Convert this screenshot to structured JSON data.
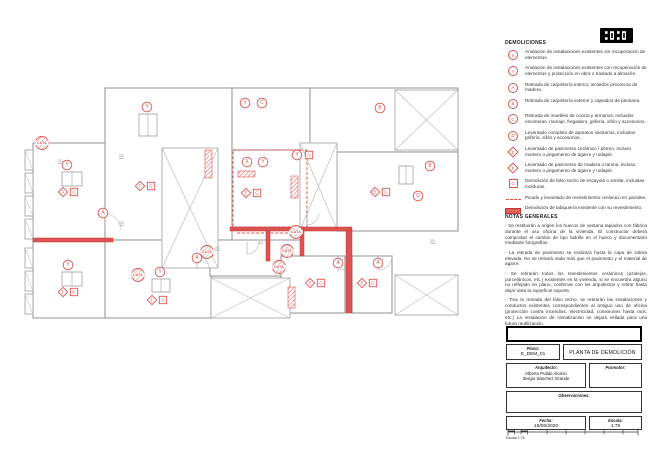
{
  "logo": {
    "name": "studio-logo"
  },
  "legend": {
    "title": "DEMOLICIONES",
    "items": [
      {
        "symbol": "circle",
        "letter": "X",
        "text": "Anulación de instalaciones existentes sin recuperación de elementos."
      },
      {
        "symbol": "circle",
        "letter": "Y",
        "text": "Anulación de instalaciones existentes con recuperación de elementos y protección en obra o traslado a almacén."
      },
      {
        "symbol": "circle",
        "letter": "A",
        "text": "Retirada de carpintería interior, incluidos precercos de madera."
      },
      {
        "symbol": "circle",
        "letter": "B",
        "text": "Retirada de carpintería exterior y cajeados de persiana."
      },
      {
        "symbol": "circle",
        "letter": "C",
        "text": "Retirada de muebles de cocina y armarios, incluidos encimeras, menaje, fregadero, grifería, sifón y accesorios."
      },
      {
        "symbol": "circle",
        "letter": "D",
        "text": "Levantado completo de aparatos sanitarios, incluidos grifería, sifón y accesorios."
      },
      {
        "symbol": "diamond",
        "letter": "E",
        "text": "Levantado de pavimento cerámico / pétreo, incluso mortero o pegamento de agarre y rodapié."
      },
      {
        "symbol": "diamond",
        "letter": "F",
        "text": "Levantado de pavimento de madera o tarima, incluso mortero o pegamento de agarre y rodapié."
      },
      {
        "symbol": "square",
        "letter": "G",
        "text": "Demolición de falso techo de escayola o similar, incluidas molduras."
      },
      {
        "symbol": "dashed-line",
        "letter": "",
        "text": "Picado y levantado de revestimiento cerámico en paredes."
      },
      {
        "symbol": "solid-wall",
        "letter": "",
        "text": "Demolición de tabiquería existente con su revestimiento."
      }
    ]
  },
  "notes": {
    "title": "NOTAS GENERALES",
    "paragraphs": [
      "- Se restituirán a origen los huecos de ventana tapiados con fábrica durante el uso oficina de la vivienda. El constructor deberá comprobar el cambio de tipo ladrillo en el hueco y documentarlo mediante fotografías.",
      "- La retirada de pavimento se realizará hasta la capa de solera elevada. No se retirará nada más que el pavimento y el material de agarre.",
      "- Se retirarán todos los revestimientos cerámicos (azulejos, porcelánicos, etc.) existentes en la vivienda, si se encuentra alguno no reflejado en plano, confirmar con los arquitectos y retirar hasta dejar vista la superficie soporte.",
      "- Tras la retirada del falso techo, se retirarán las instalaciones y conductos existentes correspondientes al antiguo uso de oficina (protección contra incendios, electricidad, conexiones hasta rack, etc.) La instalación de climatización se dejará sellada para una futura reutilización."
    ]
  },
  "titleblock": {
    "plano_label": "Plano:",
    "plano_value": "E_DEM_01",
    "title": "PLANTA DE DEMOLICIÓN",
    "arquitecto_label": "Arquitecto:",
    "arquitecto_names": [
      "Alberto Pulido Alonso",
      "Sergio Sánchez Grande"
    ],
    "promotor_label": "Promotor:",
    "observaciones_label": "Observaciones:",
    "fecha_label": "Fecha:",
    "fecha_value": "16/06/2020",
    "escala_label": "Escala:",
    "escala_value": "1:75",
    "scalebar_caption": "Escala 1:75"
  },
  "plan": {
    "colors": {
      "demolition_red": "#de5350",
      "demolition_dark": "#c23b38",
      "line_gray": "#9c9c9c"
    },
    "cata_label": "CATA",
    "rooms": [
      [
        33,
        143,
        72,
        97
      ],
      [
        33,
        240,
        72,
        78
      ],
      [
        105,
        88,
        127,
        152
      ],
      [
        105,
        240,
        106,
        78
      ],
      [
        232,
        88,
        78,
        62
      ],
      [
        310,
        88,
        148,
        64
      ],
      [
        337,
        152,
        121,
        79
      ],
      [
        210,
        240,
        91,
        36
      ],
      [
        281,
        256,
        64,
        57
      ],
      [
        352,
        256,
        40,
        57
      ]
    ],
    "xrects": [
      [
        162,
        148,
        56,
        120
      ],
      [
        395,
        90,
        63,
        60
      ],
      [
        300,
        143,
        37,
        87
      ],
      [
        211,
        278,
        79,
        40
      ],
      [
        395,
        275,
        63,
        40
      ]
    ],
    "dashed_room": [
      233,
      150,
      74,
      77
    ],
    "dashed_lines": [
      [
        237,
        233,
        293,
        233
      ]
    ],
    "red_walls": [
      [
        33,
        238,
        80,
        4
      ],
      [
        230,
        227,
        122,
        4
      ],
      [
        346,
        231,
        6,
        82
      ],
      [
        300,
        230,
        4,
        26
      ],
      [
        266,
        231,
        4,
        30
      ]
    ],
    "hatched_rects": [
      [
        205,
        150,
        7,
        28
      ],
      [
        238,
        171,
        17,
        6
      ],
      [
        291,
        176,
        7,
        22
      ],
      [
        288,
        287,
        7,
        21
      ]
    ],
    "windows": [
      [
        25,
        150,
        8,
        20
      ],
      [
        25,
        173,
        8,
        20
      ],
      [
        25,
        196,
        8,
        20
      ],
      [
        25,
        219,
        8,
        20
      ],
      [
        25,
        248,
        8,
        20
      ],
      [
        25,
        271,
        8,
        20
      ],
      [
        25,
        294,
        8,
        20
      ]
    ],
    "radiators": [
      [
        62,
        172,
        20,
        14
      ],
      [
        62,
        272,
        20,
        14
      ],
      [
        152,
        279,
        18,
        13
      ],
      [
        139,
        114,
        18,
        22
      ],
      [
        399,
        166,
        14,
        18
      ]
    ],
    "arcs": [
      [
        105,
        230,
        16,
        "up"
      ],
      [
        338,
        256,
        14,
        "down"
      ],
      [
        378,
        256,
        14,
        "down"
      ],
      [
        197,
        268,
        12,
        "up"
      ],
      [
        307,
        213,
        12,
        "down"
      ],
      [
        247,
        242,
        12,
        "down"
      ]
    ],
    "circles": [
      {
        "l": "Y",
        "x": 67,
        "y": 165
      },
      {
        "l": "Y",
        "x": 68,
        "y": 265
      },
      {
        "l": "Y",
        "x": 160,
        "y": 272
      },
      {
        "l": "Y",
        "x": 147,
        "y": 107
      },
      {
        "l": "A",
        "x": 103,
        "y": 213
      },
      {
        "l": "A",
        "x": 338,
        "y": 263
      },
      {
        "l": "A",
        "x": 378,
        "y": 263
      },
      {
        "l": "A",
        "x": 197,
        "y": 258
      },
      {
        "l": "X",
        "x": 247,
        "y": 162
      },
      {
        "l": "Y",
        "x": 263,
        "y": 162
      },
      {
        "l": "Y",
        "x": 297,
        "y": 155
      },
      {
        "l": "C",
        "x": 262,
        "y": 103
      },
      {
        "l": "Y",
        "x": 245,
        "y": 103
      },
      {
        "l": "B",
        "x": 380,
        "y": 108
      },
      {
        "l": "B",
        "x": 430,
        "y": 166
      },
      {
        "l": "D",
        "x": 418,
        "y": 196
      }
    ],
    "squares": [
      {
        "l": "G",
        "x": 309,
        "y": 155
      }
    ],
    "pairs": [
      {
        "d": "F",
        "s": "G",
        "x": 63,
        "y": 192
      },
      {
        "d": "F",
        "s": "G",
        "x": 63,
        "y": 292
      },
      {
        "d": "F",
        "s": "G",
        "x": 152,
        "y": 300
      },
      {
        "d": "F",
        "s": "G",
        "x": 140,
        "y": 186
      },
      {
        "d": "E",
        "s": "G",
        "x": 246,
        "y": 193
      },
      {
        "d": "E",
        "s": "G",
        "x": 310,
        "y": 283
      },
      {
        "d": "E",
        "s": "G",
        "x": 362,
        "y": 283
      },
      {
        "d": "E",
        "s": "G",
        "x": 375,
        "y": 192
      }
    ],
    "catas": [
      [
        42,
        143
      ],
      [
        138,
        275
      ],
      [
        207,
        252
      ],
      [
        287,
        251
      ],
      [
        279,
        267
      ],
      [
        296,
        232
      ]
    ],
    "dims": [
      [
        119,
        155
      ],
      [
        119,
        222
      ],
      [
        215,
        247
      ],
      [
        258,
        240
      ],
      [
        430,
        240
      ],
      [
        58,
        160
      ]
    ]
  }
}
